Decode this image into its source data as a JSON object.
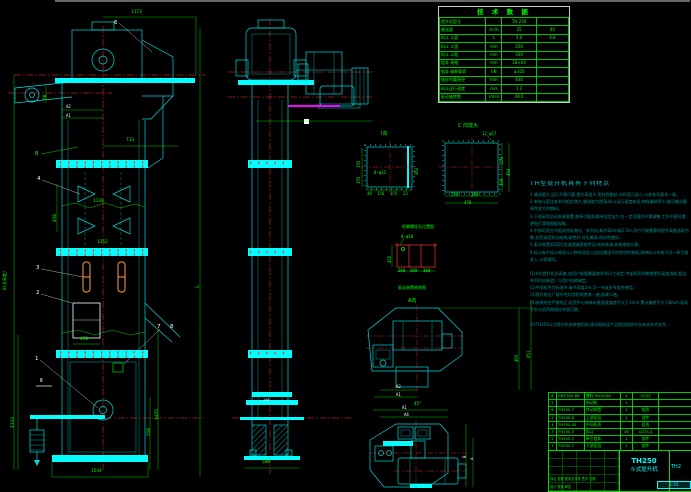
{
  "sheet": {
    "background": "#000000",
    "frame_color": "#CCCCCC"
  },
  "colors": {
    "cyan": "#00DADA",
    "bright_cyan": "#00FFFF",
    "green": "#00FF00",
    "red": "#FF3030",
    "magenta": "#FF00FF",
    "orange": "#FFA040",
    "white": "#FFFFFF",
    "teal": "#009595"
  },
  "tech_table": {
    "title": "技 术 数 据",
    "rows": [
      [
        "提升机型号",
        "",
        "TH 250",
        ""
      ],
      [
        "输送量",
        "m³/h",
        "25",
        "40"
      ],
      [
        "料斗 斗容",
        "L",
        "3.0",
        "4.8"
      ],
      [
        "料斗 斗宽",
        "mm",
        "250",
        ""
      ],
      [
        "料斗 斗距",
        "mm",
        "350",
        ""
      ],
      [
        "链条 规格",
        "mm",
        "18×64",
        ""
      ],
      [
        "链条 破断载荷",
        "kN",
        "≥320",
        ""
      ],
      [
        "链轮节圆直径",
        "mm",
        "630",
        ""
      ],
      [
        "料斗运行速度",
        "m/s",
        "1.2",
        ""
      ],
      [
        "驱动轴转数",
        "r/min",
        "48.5",
        ""
      ]
    ]
  },
  "notes": {
    "title": "TH型提升机具有下列特点",
    "features": [
      "1.输送量大,运行平稳可靠,提升高度大,密封性能好,对环境污染小,与老系列基本一致。",
      "2.有效斗容比老系列相应增大,输送能力提高,料斗运行速度较低,物料破碎率小,故可输送磨琢性较大的物料。",
      "3.下部采用自动张紧装置,使牵引链条保持恒定张力,在一定范围内不需调整,工作平稳可靠,避免打滑和脱链现象。",
      "4.中部机壳分节组成并标准化、系列化,每节高2m或2.5m,用户可按需要的提升高度选取节数,机壳采用折边结构,刚性好,外形美观,密封性能好。",
      "5.驱动装置采用ZQ型减速器直联传动,结构紧凑,安装维修方便。",
      "6.料斗有中深斗和深斗二种供选用,以适应输送不同性质的物料,两种料斗均装于同一牵引链条上,斗距相同。"
    ],
    "remarks": [
      "(1)H为提升机总高度,由用户根据需要按系列尺寸选定,中部机壳节数按提升高度选取,超出系列时由制造厂与用户协商确定。",
      "(2)中间机壳为标准节,每节高度2m,可一节或多节组合使用。",
      "(3)提升机出厂前外壳均涂防锈底漆一遍,面漆二遍。",
      "(4)安装时应严格找正,机壳中心线每米垂直度偏差不大于1mm,累计偏差不大于8mm,驱动平台与机壳联接应牢固可靠。"
    ],
    "footnote": "(5)TH250斗式提升机安装使用前,请详细阅读产品使用说明书及有关技术文件。"
  },
  "bom": {
    "rows": [
      [
        "8",
        "GB5782-86",
        "螺栓 M20×80",
        "4",
        "Q235",
        ""
      ],
      [
        "7",
        "",
        "电动机",
        "1",
        "",
        ""
      ],
      [
        "6",
        "TH250.7",
        "传动装置",
        "1",
        "组合",
        ""
      ],
      [
        "5",
        "TH250.6",
        "上部区段",
        "1",
        "部件",
        ""
      ],
      [
        "4",
        "TH250.45",
        "中间机壳",
        "",
        "组合",
        ""
      ],
      [
        "3",
        "TH250.3",
        "料斗",
        "46",
        "Q235-A",
        ""
      ],
      [
        "2",
        "TH250.2",
        "牵引链条",
        "2",
        "部件",
        ""
      ],
      [
        "1",
        "TH250.1",
        "下部区段",
        "1",
        "部件",
        ""
      ]
    ],
    "headers": [
      "件号",
      "代号",
      "名称",
      "数量",
      "材料",
      "备注"
    ]
  },
  "title_block": {
    "model": "TH250",
    "product": "斗式提升机",
    "drawing_no": "TH2",
    "scale": "1:25",
    "rev_header": "标记 处数 更改文件号 签字 日期",
    "staff_row": "设计  校核  审定"
  },
  "balloons": {
    "b1": "1",
    "b2": "2",
    "b3": "3",
    "b4": "4",
    "b6": "6",
    "b7": "7",
    "b8": "8"
  },
  "dims": {
    "w1173": "1173",
    "w713": "713",
    "v450": "450",
    "v1130": "1130",
    "v1352": "1352",
    "box450": "450",
    "w1544": "1544",
    "v1333": "1333",
    "v550": "550",
    "v1425": "1425",
    "v50": "50",
    "a2": "A2",
    "a1": "A1",
    "L": "L",
    "H": "H(总高度)",
    "sec2": "Ⅱ",
    "B": "B",
    "w500": "500",
    "w140": "140",
    "iv_title": "Ⅰ向",
    "iv_holes": "8-φ12",
    "iv_155a": "155",
    "iv_155b": "155",
    "iv_360": "360",
    "iv_40": "40",
    "iv_156": "156",
    "iv_155c": "155",
    "iv_22": "22",
    "cv_title": "C 向放大",
    "cv_holes": "12-φ17",
    "cv_250": "250",
    "cv_300": "300",
    "cv_450": "450",
    "cv_b250": "250",
    "cv_b300": "300",
    "cv_478": "478",
    "an_title": "地脚螺栓孔位置图",
    "an_holes": "8-φ18",
    "an_435": "435",
    "an_200": "200",
    "an_300a": "300",
    "an_300b": "300",
    "tv_label1": "驱动装置俯视图",
    "tv_label2": "A向",
    "tv_465": "465",
    "tv_651": "651",
    "tv_a2": "A2",
    "tv_a1": "A1",
    "bv_45": "45°",
    "bv_a1": "A1",
    "bv_a4": "A4",
    "bv_B": "B",
    "bv_a": "a"
  }
}
